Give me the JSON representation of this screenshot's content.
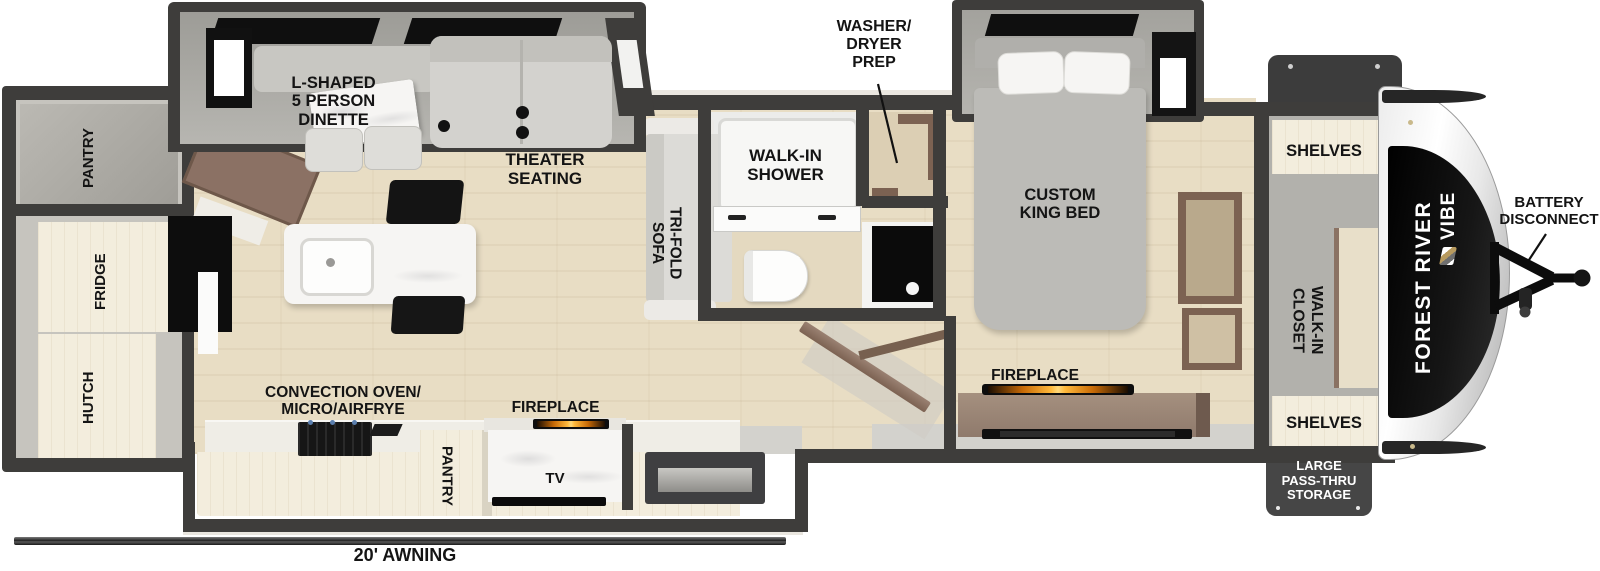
{
  "floorplan": {
    "brand": {
      "maker": "FOREST RIVER",
      "model": "VIBE"
    },
    "labels": {
      "rear_pantry": "PANTRY",
      "fridge": "FRIDGE",
      "hutch": "HUTCH",
      "dinette": [
        "L-SHAPED",
        "5 PERSON",
        "DINETTE"
      ],
      "theater": [
        "THEATER",
        "SEATING"
      ],
      "sofa": [
        "TRI-FOLD",
        "SOFA"
      ],
      "shower": [
        "WALK-IN",
        "SHOWER"
      ],
      "washer": [
        "WASHER/",
        "DRYER",
        "PREP"
      ],
      "bed": [
        "CUSTOM",
        "KING BED"
      ],
      "bedroom_fireplace": "FIREPLACE",
      "shelves_top": "SHELVES",
      "closet": [
        "WALK-IN",
        "CLOSET"
      ],
      "shelves_bottom": "SHELVES",
      "battery": [
        "BATTERY",
        "DISCONNECT"
      ],
      "storage": [
        "LARGE",
        "PASS-THRU",
        "STORAGE"
      ],
      "appliance": [
        "CONVECTION OVEN/",
        "MICRO/AIRFRYE"
      ],
      "kitchen_fireplace": "FIREPLACE",
      "kitchen_pantry": "PANTRY",
      "tv": "TV",
      "awning": "20' AWNING"
    },
    "colors": {
      "wall": "#3e3d3b",
      "floor_wood": "#e8ddc4",
      "floor_gray": "#d3d2cd",
      "cabinet_cream": "#f3eddd",
      "wood_trim": "#8a7263",
      "flame": "#f59b0c",
      "storage_chip": "#464646",
      "label": "#141414"
    }
  }
}
